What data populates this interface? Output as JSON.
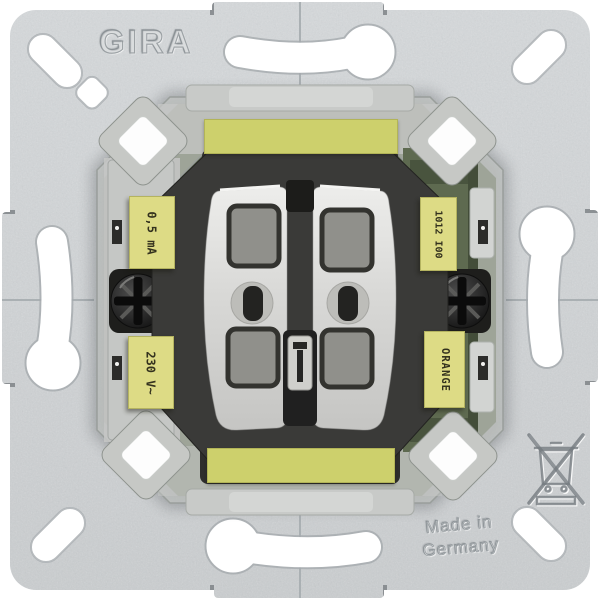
{
  "plate": {
    "brand": "GIRA",
    "made_in_line1": "Made in",
    "made_in_line2": "Germany"
  },
  "device_labels": {
    "left_top": "0,5 mA",
    "left_bottom": "230 V~",
    "right_top": "1012 I00",
    "right_bottom": "ORANGE"
  },
  "icons": {
    "weee": "crossed-out-wheelie-bin-icon"
  },
  "colors": {
    "background": "#ffffff",
    "plate_metal": "#ced1d3",
    "label_yellow": "#dddb85",
    "strip_yellow": "#cdd06c",
    "pcb_olive": "#5e6a50",
    "rocker_gray": "#d6d6d4",
    "housing_dark": "#3a3a38",
    "screw_dark": "#1c1c1c"
  }
}
